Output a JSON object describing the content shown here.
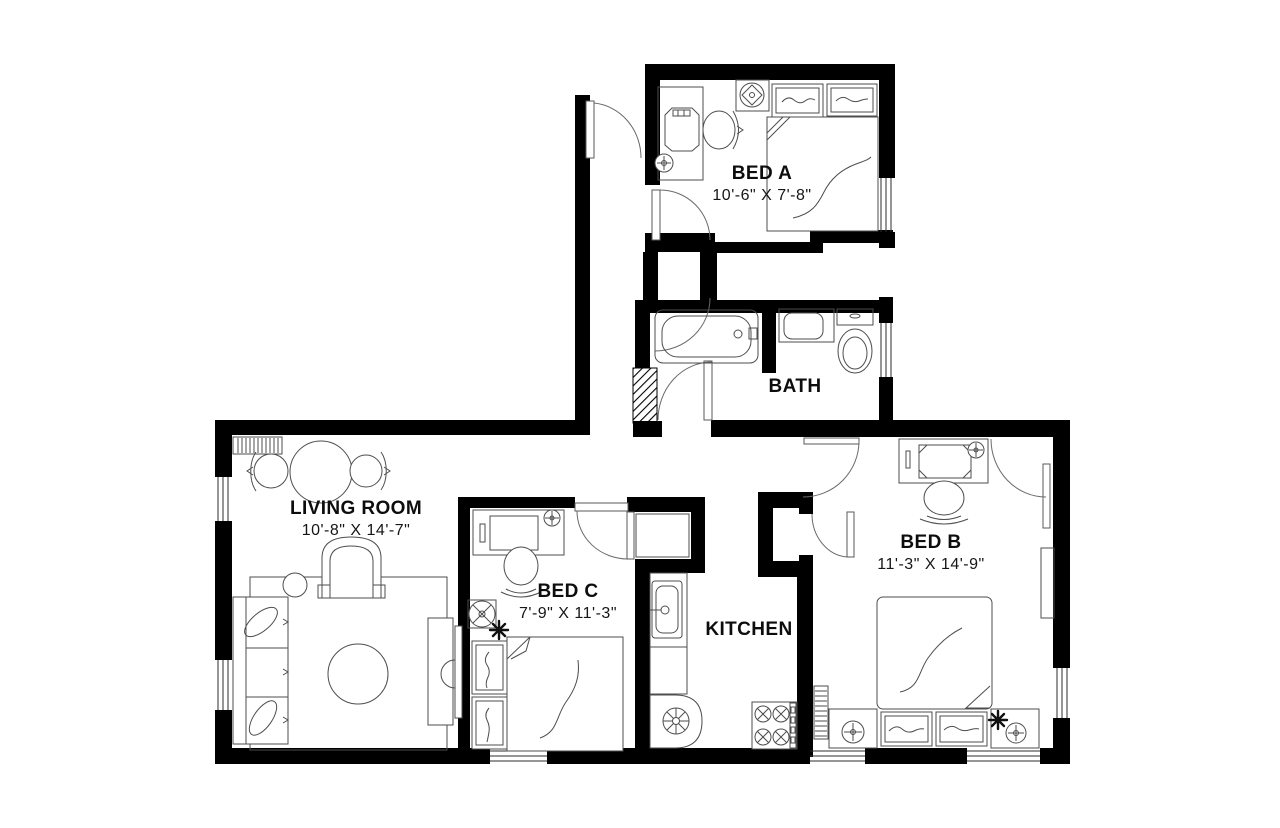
{
  "rooms": [
    {
      "name": "BED A",
      "dimensions": "10'-6\" X 7'-8\""
    },
    {
      "name": "BATH",
      "dimensions": ""
    },
    {
      "name": "LIVING ROOM",
      "dimensions": "10'-8\" X 14'-7\""
    },
    {
      "name": "BED C",
      "dimensions": "7'-9\" X 11'-3\""
    },
    {
      "name": "KITCHEN",
      "dimensions": ""
    },
    {
      "name": "BED B",
      "dimensions": "11'-3\" X 14'-9\""
    }
  ],
  "colors": {
    "walls": "#000000",
    "furniture_lines": "#4d4d4d",
    "background": "#ffffff"
  }
}
